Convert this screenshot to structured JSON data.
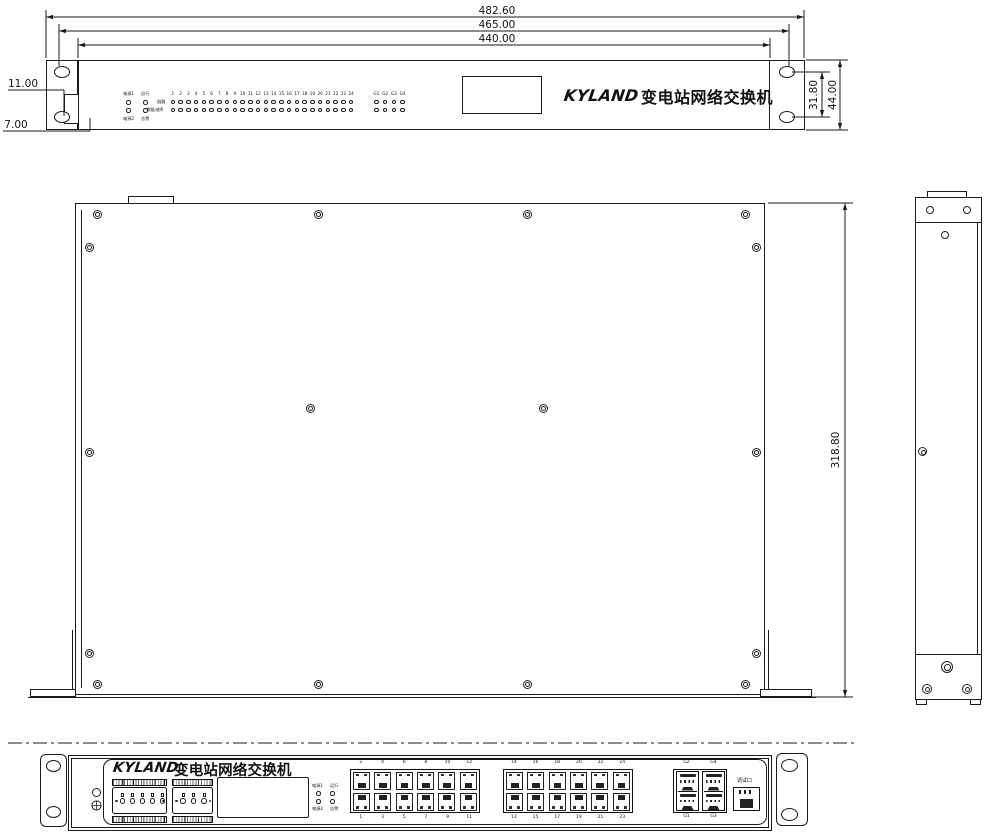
{
  "brand": {
    "logo_text": "KYLAND",
    "product_name": "变电站网络交换机"
  },
  "dimensions": {
    "overall_width": "482.60",
    "mount_hole_span": "465.00",
    "body_width": "440.00",
    "ear_detail_upper": "11.00",
    "ear_detail_lower": "7.00",
    "ear_hole_span": "31.80",
    "panel_height": "44.00",
    "chassis_depth": "318.80"
  },
  "front_panel_top_view": {
    "led_labels": {
      "power1": "电源1",
      "run": "运行",
      "power2": "电源2",
      "alarm": "告警",
      "row_link": "链路",
      "row_speed": "数据/速率"
    },
    "port_numbers": [
      "1",
      "2",
      "3",
      "4",
      "5",
      "6",
      "7",
      "8",
      "9",
      "10",
      "11",
      "12",
      "13",
      "14",
      "15",
      "16",
      "17",
      "18",
      "19",
      "20",
      "21",
      "22",
      "23",
      "24"
    ],
    "g_port_numbers": [
      "G1",
      "G2",
      "G3",
      "G4"
    ]
  },
  "bottom_front_panel": {
    "led_labels": {
      "power1": "电源1",
      "run": "运行",
      "power2": "电源2",
      "alarm": "告警"
    },
    "port_group1": {
      "top": [
        "2",
        "4",
        "6",
        "8",
        "10",
        "12"
      ],
      "bottom": [
        "1",
        "3",
        "5",
        "7",
        "9",
        "11"
      ]
    },
    "port_group2": {
      "top": [
        "14",
        "16",
        "18",
        "20",
        "22",
        "24"
      ],
      "bottom": [
        "13",
        "15",
        "17",
        "19",
        "21",
        "23"
      ]
    },
    "g_ports": {
      "top": [
        "G2",
        "G4"
      ],
      "bottom": [
        "G1",
        "G3"
      ]
    },
    "debug_port_label": "调试口"
  }
}
